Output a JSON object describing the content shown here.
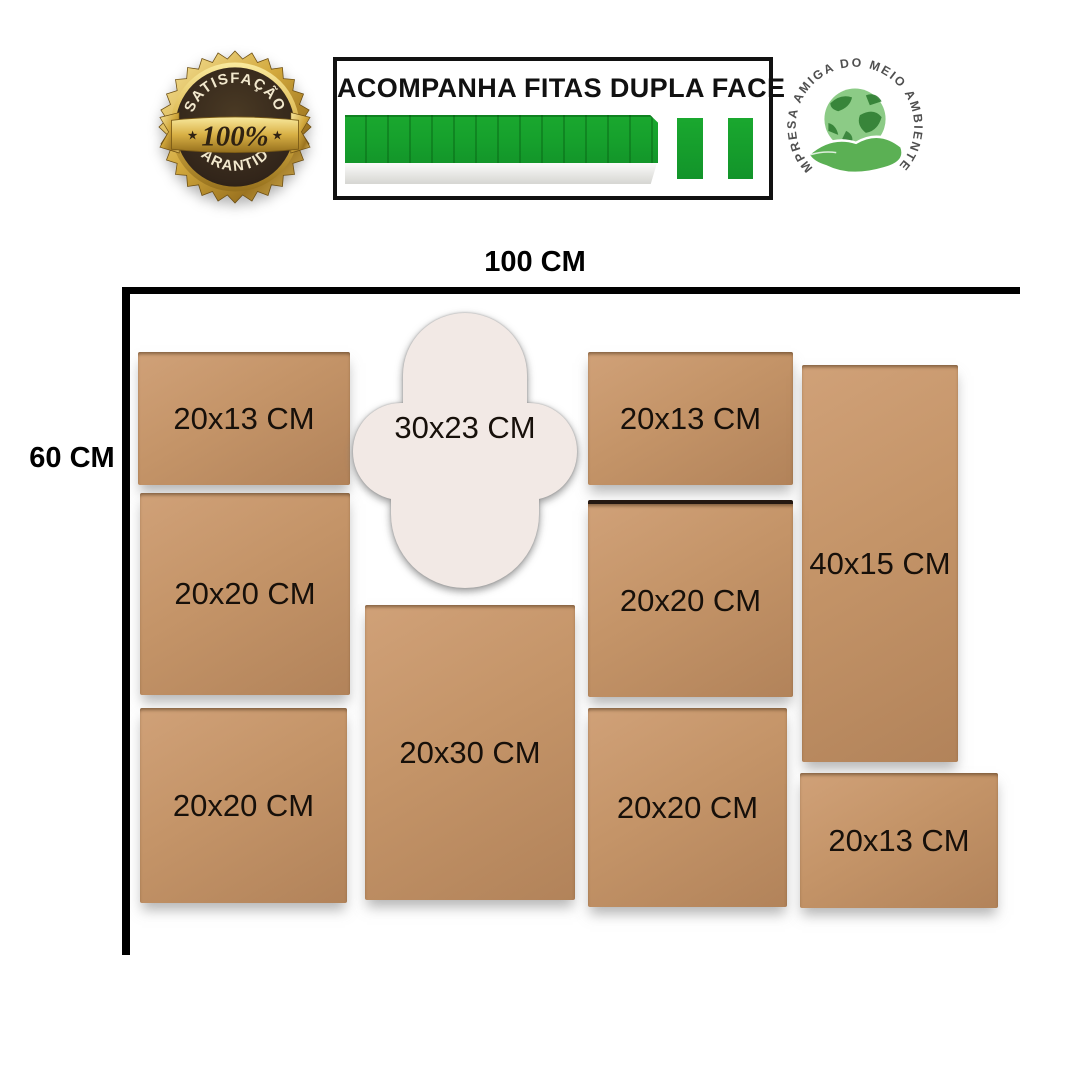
{
  "badge": {
    "top_text": "SATISFAÇÃO",
    "center_text": "100%",
    "bottom_text": "GARANTIDA",
    "star": "★",
    "colors": {
      "gold_light": "#f6e08a",
      "gold": "#caa032",
      "gold_dark": "#8a621a",
      "inner_dark": "#312415",
      "text_light": "#f2e8cd",
      "ribbon_text": "#2f2212"
    }
  },
  "tape_box": {
    "title": "ACOMPANHA FITAS DUPLA FACE",
    "tape_color": "#16a02c",
    "backing_color": "#d6d6d2",
    "border_color": "#111111"
  },
  "eco_stamp": {
    "text": "EMPRESA AMIGA DO MEIO AMBIENTE -",
    "text_color": "#4f4f4f",
    "globe_color": "#8ccb86",
    "land_color": "#2f7d32",
    "hand_color": "#5bb054"
  },
  "diagram": {
    "width_label": "100 CM",
    "height_label": "60 CM",
    "axis_color": "#000000",
    "board_color": "#c49468",
    "plaque": {
      "label": "30x23 CM"
    },
    "boards": [
      {
        "label": "20x13 CM",
        "position": "top-left"
      },
      {
        "label": "20x13 CM",
        "position": "top-right"
      },
      {
        "label": "40x15 CM",
        "position": "right-column"
      },
      {
        "label": "20x20 CM",
        "position": "middle-left"
      },
      {
        "label": "20x20 CM",
        "position": "middle-right"
      },
      {
        "label": "20x30 CM",
        "position": "center-bottom"
      },
      {
        "label": "20x20 CM",
        "position": "bottom-left"
      },
      {
        "label": "20x20 CM",
        "position": "bottom-right"
      },
      {
        "label": "20x13 CM",
        "position": "far-bottom-right"
      }
    ]
  }
}
